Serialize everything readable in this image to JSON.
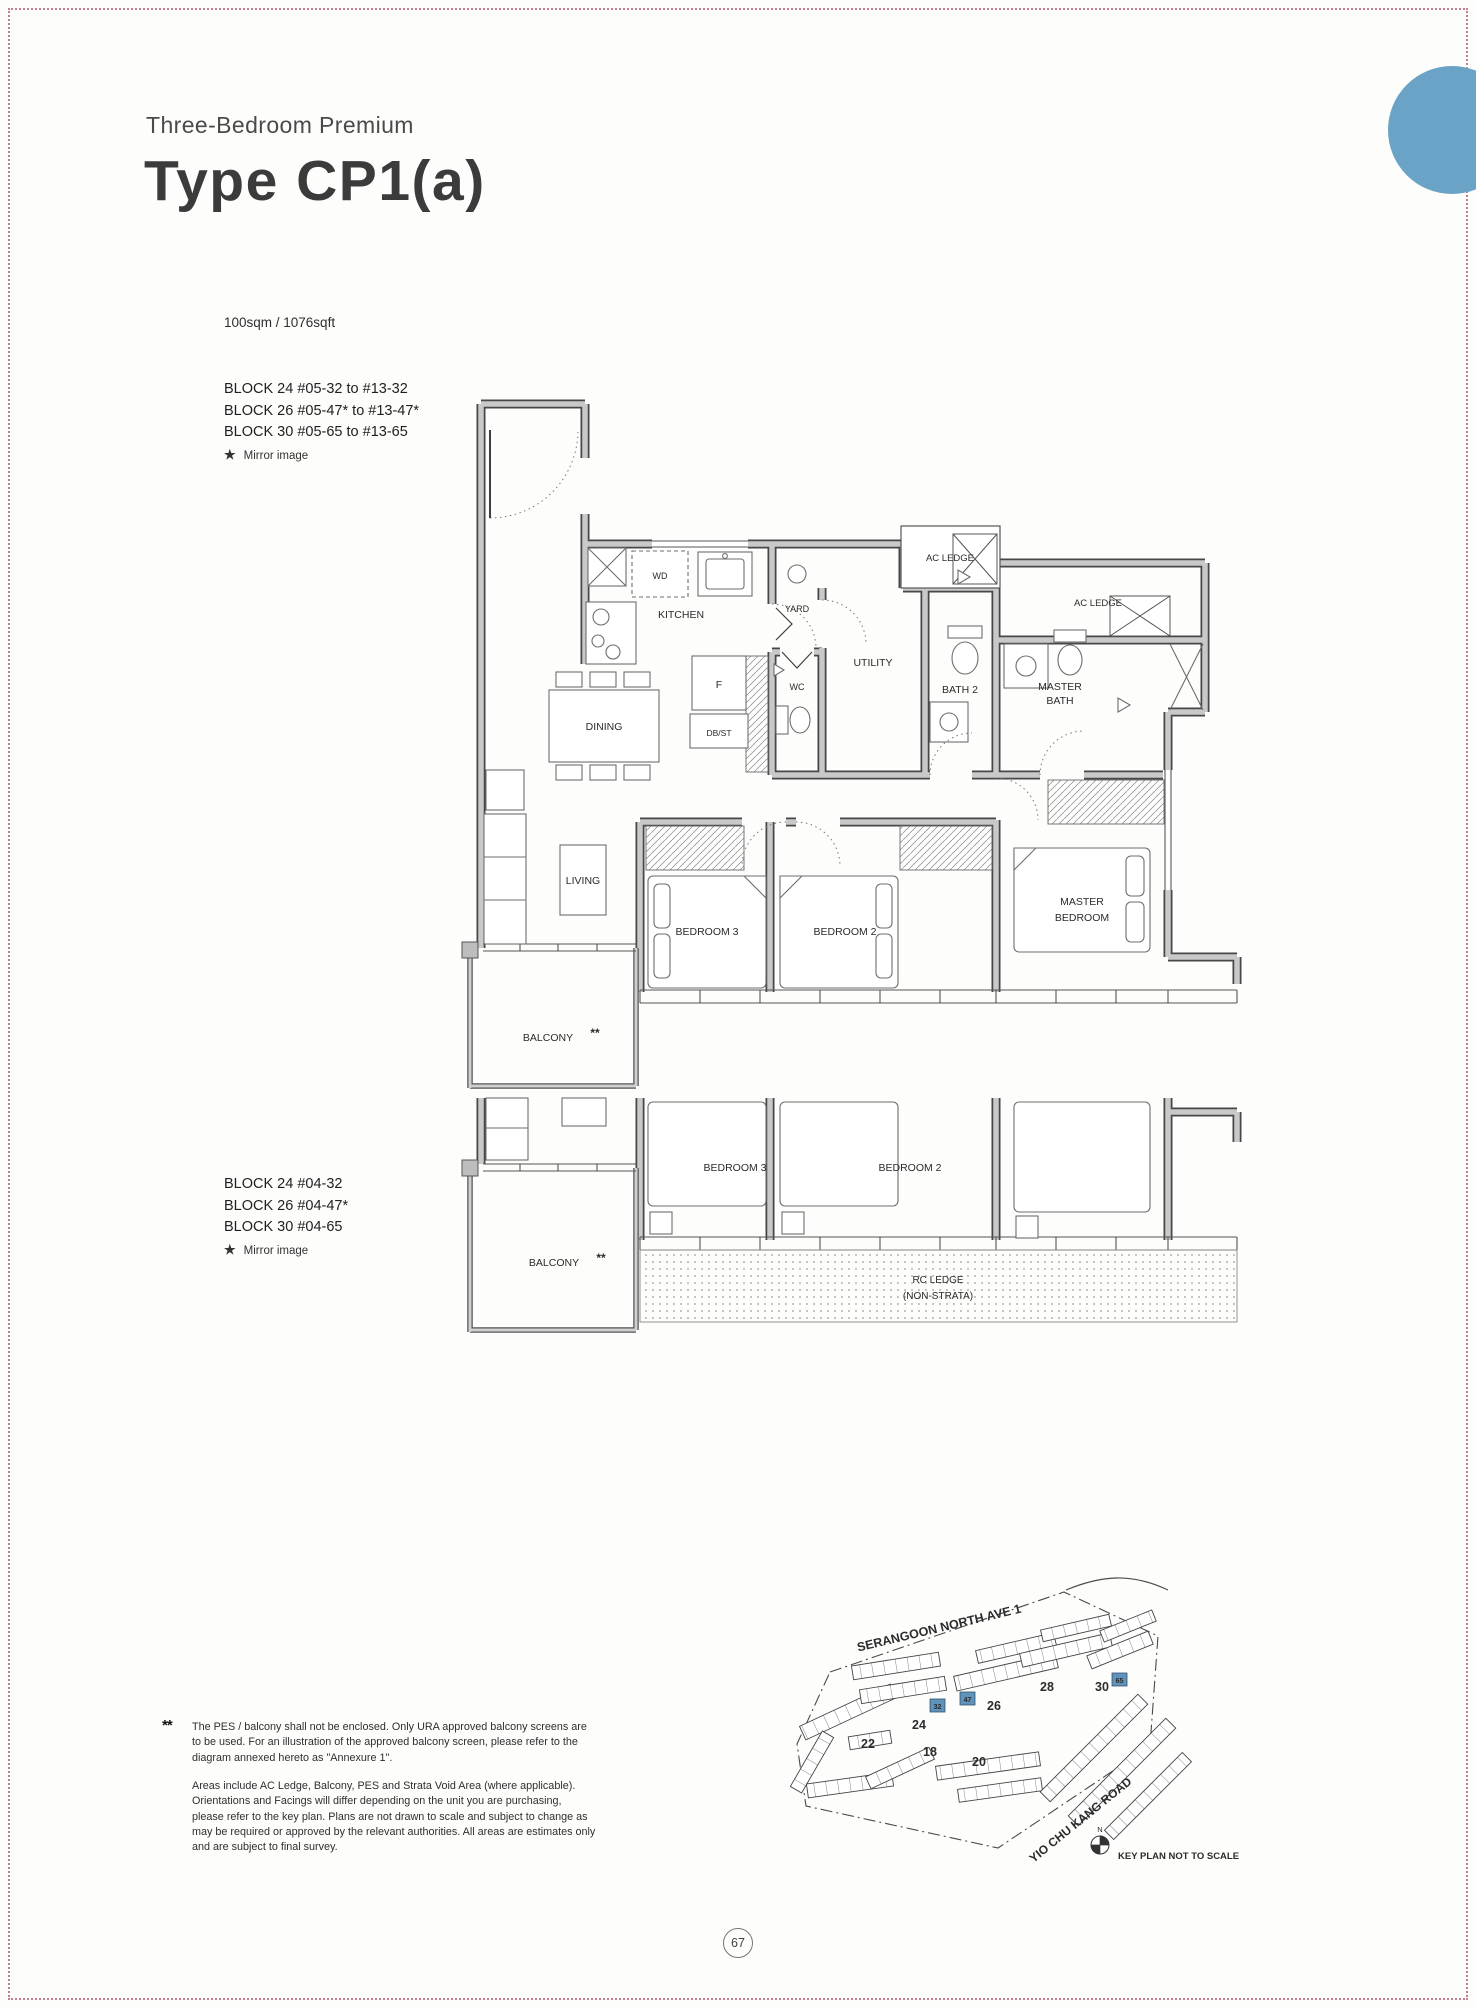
{
  "page": {
    "number": "67",
    "accent_color": "#6BA3C7",
    "border_color": "#C07E8C"
  },
  "header": {
    "subtitle": "Three-Bedroom Premium",
    "title": "Type CP1(a)",
    "area": "100sqm / 1076sqft"
  },
  "upper_plan_info": {
    "blocks": [
      "BLOCK 24 #05-32 to #13-32",
      "BLOCK 26 #05-47* to #13-47*",
      "BLOCK 30 #05-65 to #13-65"
    ],
    "star": "★",
    "mirror_note": "Mirror image"
  },
  "lower_plan_info": {
    "blocks": [
      "BLOCK 24 #04-32",
      "BLOCK 26 #04-47*",
      "BLOCK 30 #04-65"
    ],
    "star": "★",
    "mirror_note": "Mirror image"
  },
  "floorplan": {
    "labels": {
      "kitchen": "KITCHEN",
      "wd": "WD",
      "yard": "YARD",
      "utility": "UTILITY",
      "wc": "WC",
      "bath2": "BATH 2",
      "master_bath_1": "MASTER",
      "master_bath_2": "BATH",
      "ac_ledge": "AC LEDGE",
      "dining": "DINING",
      "living": "LIVING",
      "fridge": "F",
      "dbst": "DB/ST",
      "bedroom3": "BEDROOM 3",
      "bedroom2": "BEDROOM 2",
      "master_bedroom_1": "MASTER",
      "master_bedroom_2": "BEDROOM",
      "balcony": "BALCONY",
      "balcony_stars": "**",
      "rc_ledge_1": "RC LEDGE",
      "rc_ledge_2": "(NON-STRATA)"
    }
  },
  "footnotes": {
    "marker": "**",
    "note1": "The PES / balcony shall not be enclosed. Only URA approved balcony screens are to be used. For an illustration of the approved balcony screen, please refer to the diagram annexed hereto as \"Annexure 1\".",
    "note2": "Areas include AC Ledge, Balcony, PES and Strata Void Area (where applicable). Orientations and Facings will differ depending on the unit you are purchasing, please refer to the key plan. Plans are not drawn to scale and subject to change as may be required or approved by the relevant authorities. All areas are estimates only and are subject to final survey."
  },
  "keyplan": {
    "road1": "SERANGOON NORTH AVE 1",
    "road2": "YIO CHU KANG ROAD",
    "caption": "KEY PLAN NOT TO SCALE",
    "north": "N",
    "block_labels": {
      "b22": "22",
      "b24": "24",
      "b18": "18",
      "b20": "20",
      "b26": "26",
      "b28": "28",
      "b30": "30"
    },
    "highlighted_units": {
      "u32": "32",
      "u47": "47",
      "u65": "65"
    },
    "highlight_color": "#5F93BB"
  }
}
